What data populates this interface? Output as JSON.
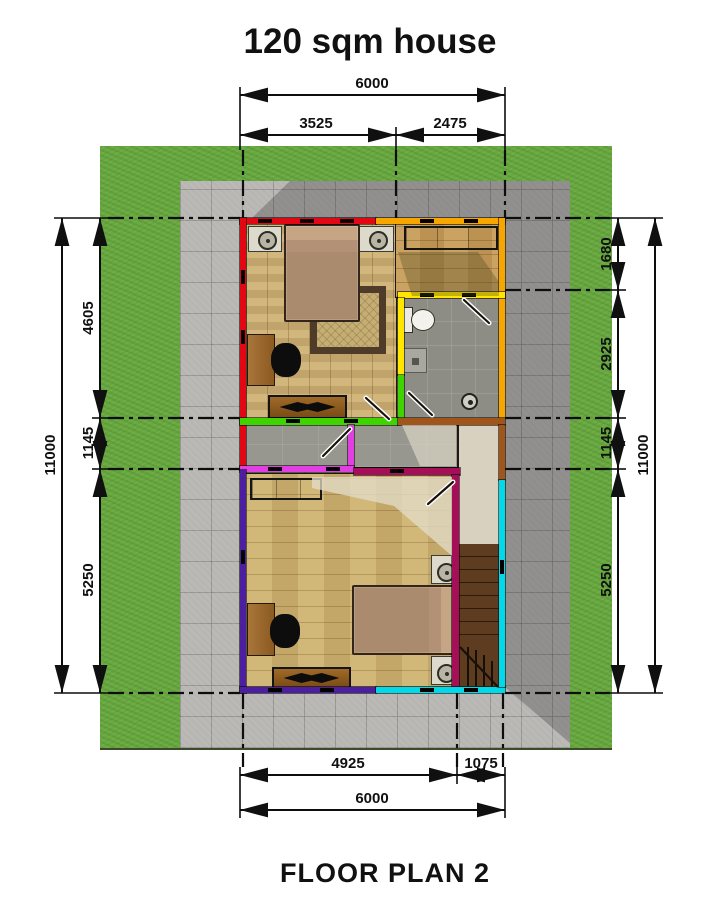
{
  "title": "120 sqm house",
  "caption": "FLOOR PLAN 2",
  "dimensions": {
    "top": {
      "overall": "6000",
      "segments": [
        "3525",
        "2475"
      ]
    },
    "bottom": {
      "overall": "6000",
      "segments": [
        "4925",
        "1075"
      ]
    },
    "left": {
      "overall": "11000",
      "segments": [
        "4605",
        "1145",
        "5250"
      ]
    },
    "right": {
      "overall": "11000",
      "segments": [
        "1680",
        "2925",
        "1145",
        "5250"
      ]
    }
  },
  "colors": {
    "grass": "#67a93e",
    "pavement": "#b7b6b3",
    "wall_red": "#e30613",
    "wall_orange": "#f7a600",
    "wall_yellow": "#ffe500",
    "wall_green": "#3fd400",
    "wall_magenta": "#e13fe1",
    "wall_maroon": "#a50f57",
    "wall_purple": "#4b1fa0",
    "wall_cyan": "#00d9e9",
    "wall_sienna": "#a0551a",
    "wood_floor": "#c9ae74",
    "tile_floor": "#8d8d85",
    "stair_tread": "#5e3c1f"
  }
}
